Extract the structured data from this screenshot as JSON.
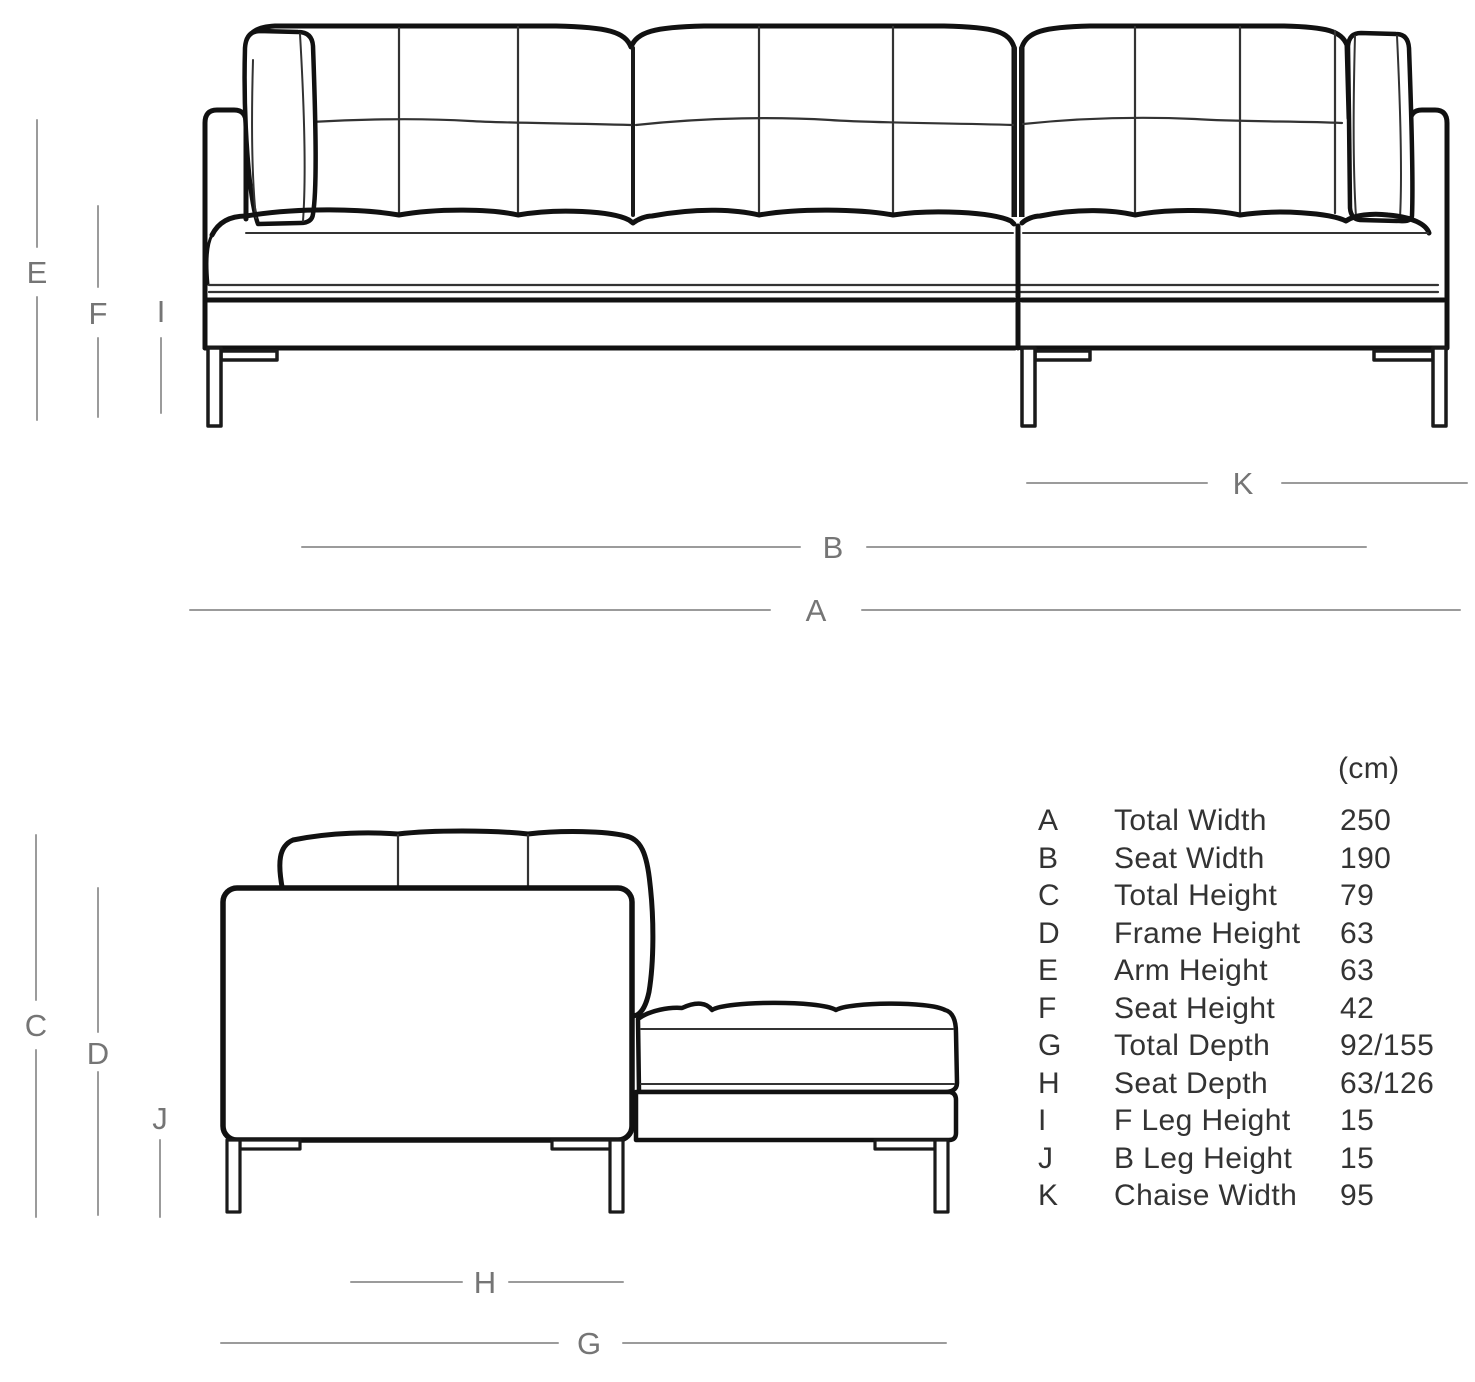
{
  "front_view": {
    "dimension_labels": {
      "E": "E",
      "F": "F",
      "I": "I",
      "K": "K",
      "B": "B",
      "A": "A"
    }
  },
  "side_view": {
    "dimension_labels": {
      "C": "C",
      "D": "D",
      "J": "J",
      "H": "H",
      "G": "G"
    }
  },
  "dimensions_table": {
    "unit_header": "(cm)",
    "rows": [
      {
        "letter": "A",
        "name": "Total Width",
        "value": "250"
      },
      {
        "letter": "B",
        "name": "Seat Width",
        "value": "190"
      },
      {
        "letter": "C",
        "name": "Total Height",
        "value": "79"
      },
      {
        "letter": "D",
        "name": "Frame Height",
        "value": "63"
      },
      {
        "letter": "E",
        "name": "Arm Height",
        "value": "63"
      },
      {
        "letter": "F",
        "name": "Seat Height",
        "value": "42"
      },
      {
        "letter": "G",
        "name": "Total Depth",
        "value": "92/155"
      },
      {
        "letter": "H",
        "name": "Seat Depth",
        "value": "63/126"
      },
      {
        "letter": "I",
        "name": "F Leg Height",
        "value": "15"
      },
      {
        "letter": "J",
        "name": "B Leg Height",
        "value": "15"
      },
      {
        "letter": "K",
        "name": "Chaise Width",
        "value": "95"
      }
    ]
  },
  "colors": {
    "line_art": "#111111",
    "thin_seam": "#333333",
    "dimension_line": "#9b9b9b",
    "dimension_label": "#757575",
    "table_text": "#333333",
    "background": "#ffffff"
  }
}
